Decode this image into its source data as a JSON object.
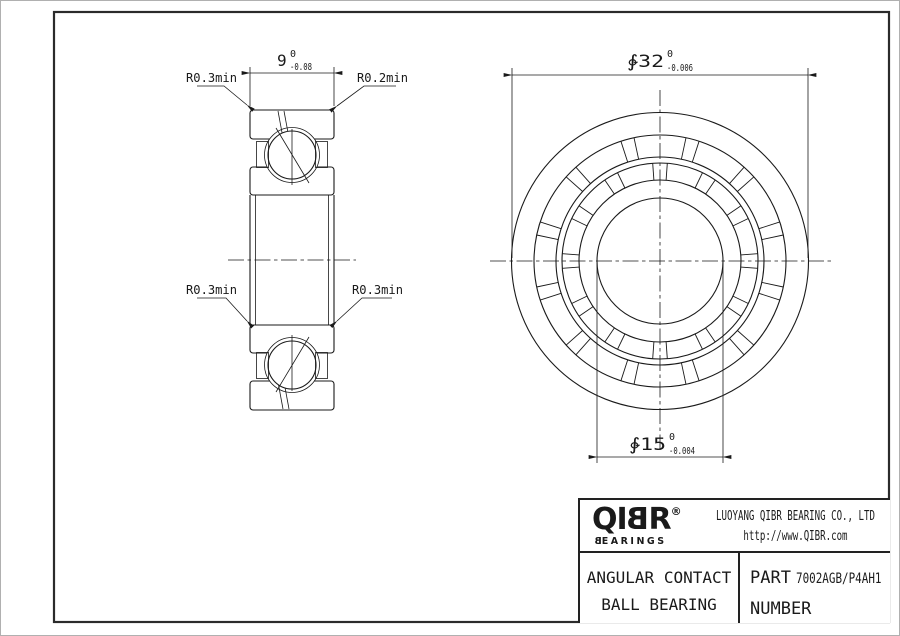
{
  "left_view": {
    "dim_width": {
      "value": "9",
      "tol_top": "0",
      "tol_bottom": "-0.08"
    },
    "labels": {
      "top_left": "R0.3min",
      "top_right": "R0.2min",
      "bottom_left": "R0.3min",
      "bottom_right": "R0.3min"
    }
  },
  "front_view": {
    "dim_outer": {
      "value": "∲32",
      "tol_top": "0",
      "tol_bottom": "-0.006"
    },
    "dim_bore": {
      "value": "∲15",
      "tol_top": "0",
      "tol_bottom": "-0.004"
    }
  },
  "title_block": {
    "logo": {
      "pre": "QI",
      "mirrored_b": "B",
      "post": "R",
      "registered": "®",
      "sub_pre": "B",
      "sub_post": "EARINGS"
    },
    "company": "LUOYANG QIBR BEARING CO., LTD",
    "website": "http://www.QIBR.com",
    "product_line1": "ANGULAR CONTACT",
    "product_line2": "BALL BEARING",
    "part_label_line1": "PART",
    "part_label_line2": "NUMBER",
    "part_number": "7002AGB/P4AH1"
  },
  "colors": {
    "line": "#1a1a1a",
    "frame_border": "#2b2b2b",
    "page_edge": "#b0b0b0"
  }
}
